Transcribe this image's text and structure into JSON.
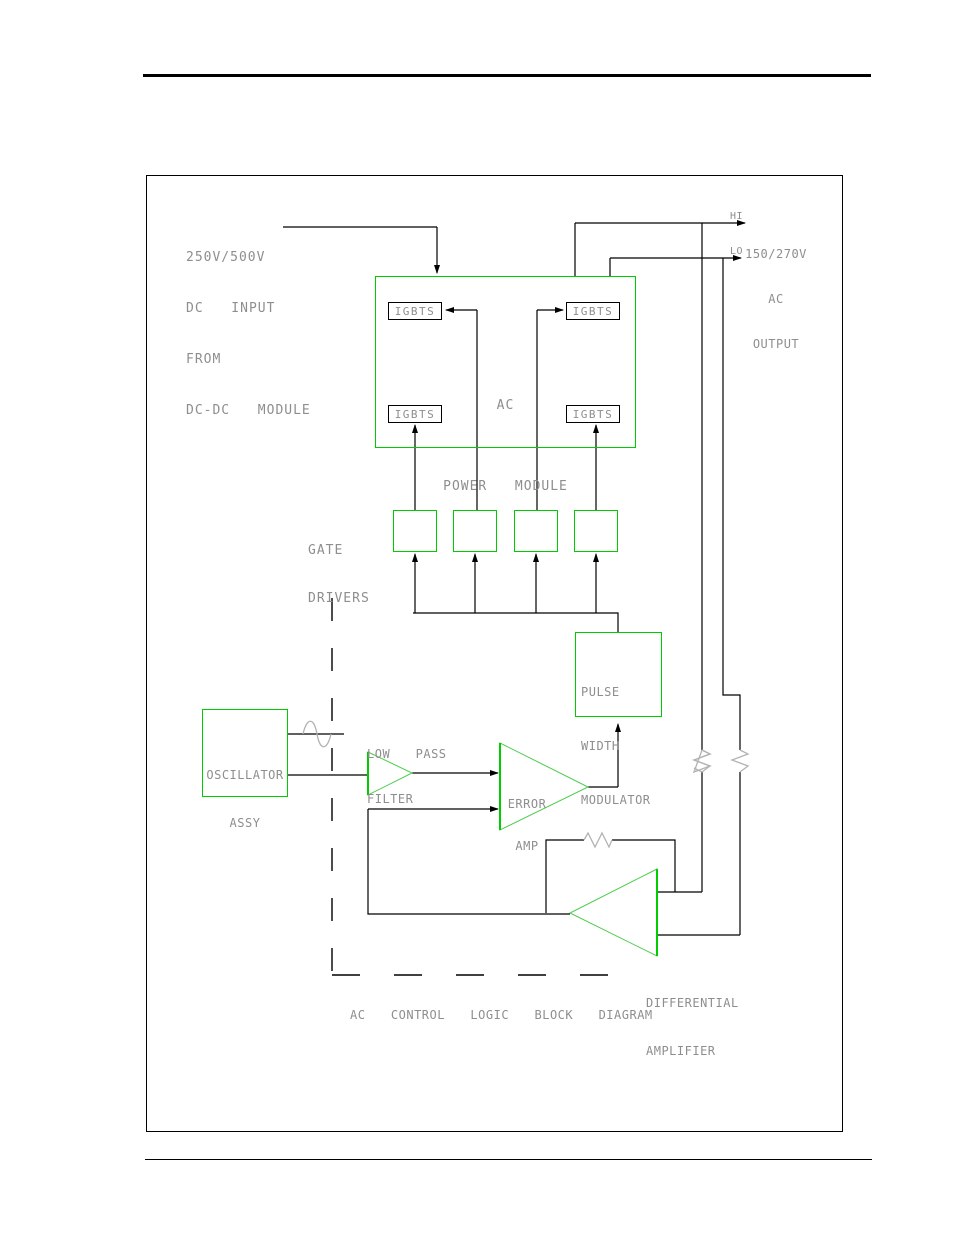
{
  "colors": {
    "box_green": "#00cc00",
    "wire_black": "#000000",
    "text_gray": "#8e8e8e",
    "resistor_gray": "#b3b3b3"
  },
  "diagram": {
    "caption": "AC  CONTROL  LOGIC  BLOCK  DIAGRAM",
    "dc_input": [
      "250V/500V",
      "DC  INPUT",
      "FROM",
      "DC-DC  MODULE"
    ],
    "ac_output": {
      "hi": "HI",
      "lo": "LO",
      "label": [
        "150/270V",
        "AC",
        "OUTPUT"
      ]
    },
    "power_module": {
      "title": [
        "AC",
        "POWER  MODULE"
      ],
      "igbts": [
        "IGBTS",
        "IGBTS",
        "IGBTS",
        "IGBTS"
      ]
    },
    "gate_drivers": [
      "GATE",
      "DRIVERS"
    ],
    "pwm": [
      "PULSE",
      "WIDTH",
      "MODULATOR"
    ],
    "oscillator": [
      "OSCILLATOR",
      "ASSY"
    ],
    "low_pass_filter": [
      "LOW  PASS",
      "FILTER"
    ],
    "error_amp": [
      "ERROR",
      "AMP"
    ],
    "differential_amplifier": [
      "DIFFERENTIAL",
      "AMPLIFIER"
    ]
  }
}
